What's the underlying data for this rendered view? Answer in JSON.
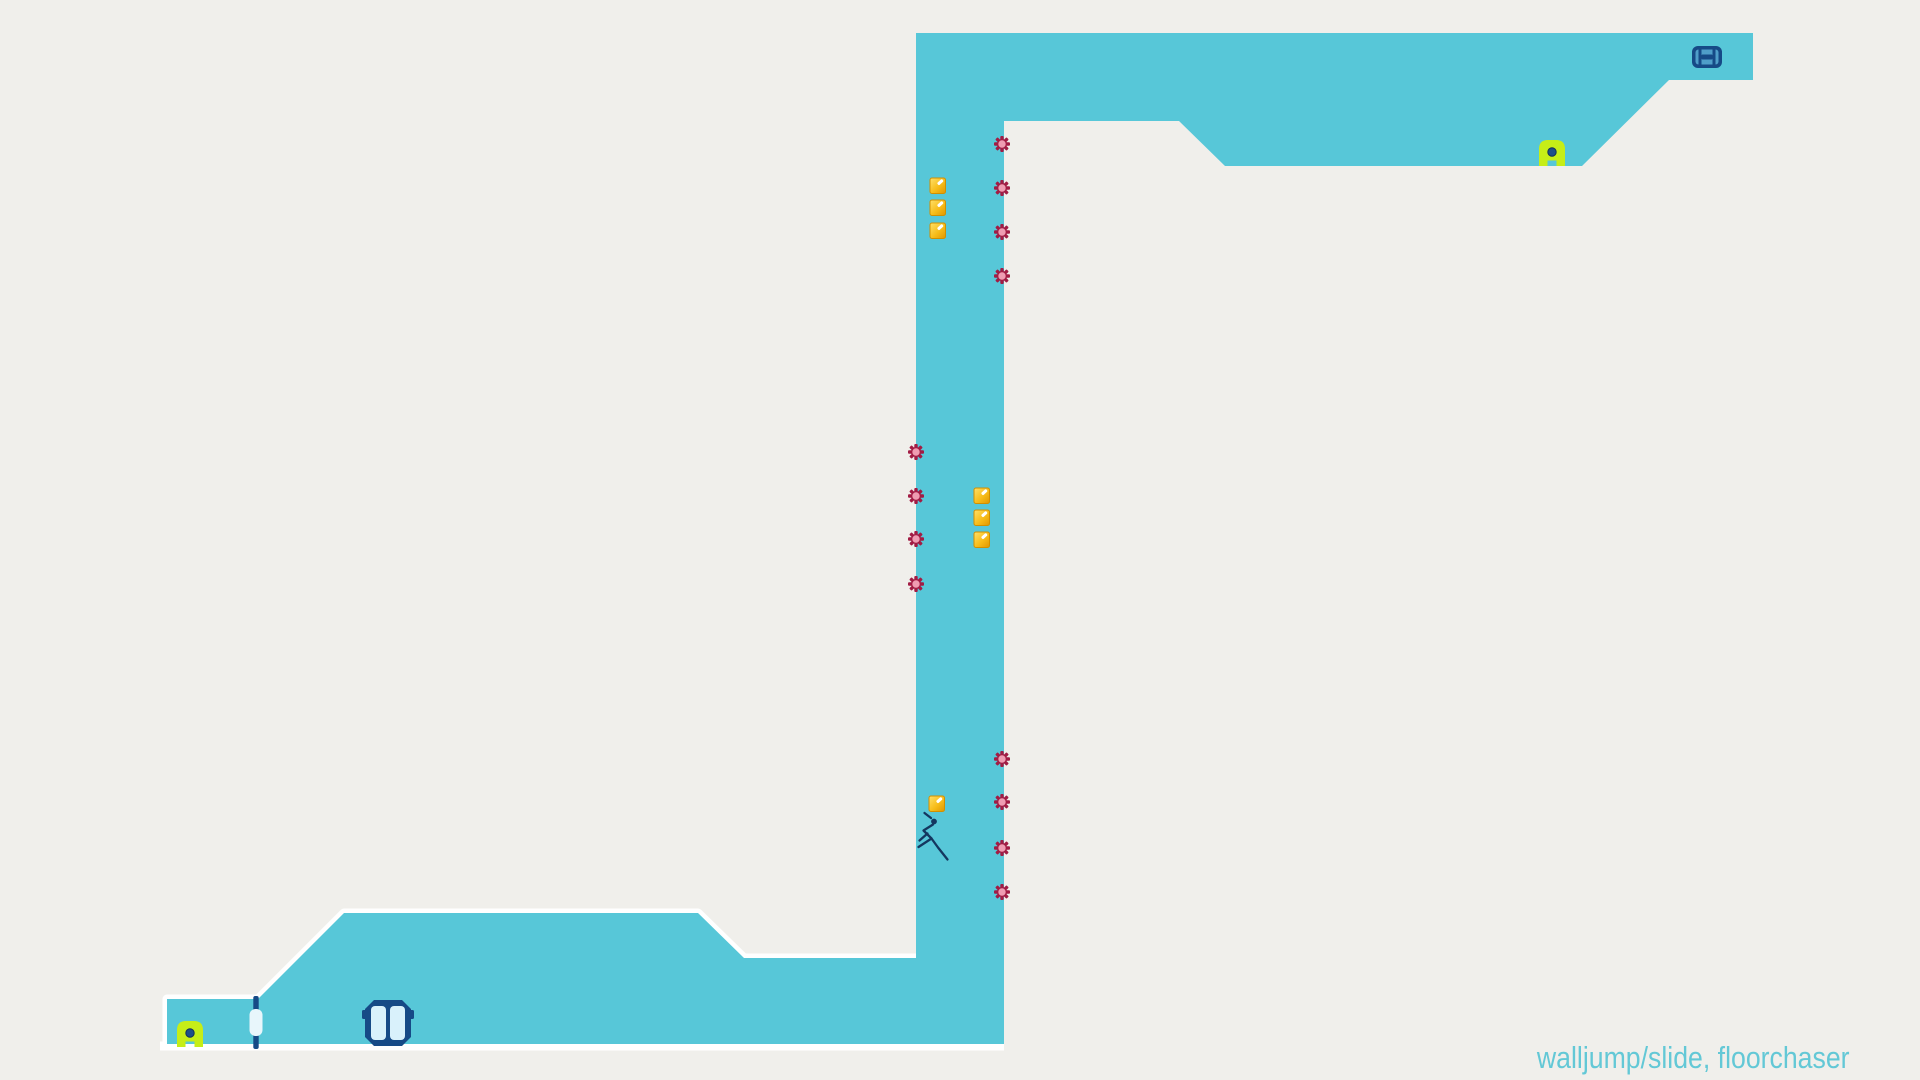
{
  "caption": "walljump/slide, floorchaser",
  "colors": {
    "bg": "#f0efeb",
    "terrain": "#57c7d8",
    "boundary": "#ffffff",
    "caption": "#63c8d6",
    "navy": "#164a86",
    "navy_dark": "#123a66",
    "door_panel": "#d9f1fb",
    "door_pill": "#e8f6fb",
    "switch_inner": "#4f9ec9",
    "gold_light": "#ffe06a",
    "gold_mid": "#f7bd1a",
    "gold_dark": "#e09600",
    "gold_edge": "#d18f00",
    "gold_shine": "#ffffff",
    "mine_dark": "#a21c44",
    "mine_light": "#ef9cb2",
    "guard_body": "#c6ee17",
    "guard_eye": "#1d4f8a",
    "guard_eye_rim": "#123057",
    "player_stroke": "#14375f"
  },
  "level": {
    "outline": [
      [
        916,
        33
      ],
      [
        1753,
        33
      ],
      [
        1753,
        80
      ],
      [
        1669,
        80
      ],
      [
        1582,
        166
      ],
      [
        1225,
        166
      ],
      [
        1179,
        121
      ],
      [
        1004,
        121
      ],
      [
        1004,
        1044
      ],
      [
        167,
        1044
      ],
      [
        167,
        999
      ],
      [
        258,
        999
      ],
      [
        344,
        913
      ],
      [
        698,
        913
      ],
      [
        744,
        958
      ],
      [
        916,
        958
      ]
    ],
    "white_outline_path": "M167,1050 L167,999 L258,999 L344,913 L698,913 L744,958 L916,958 M160,1046 L1004,1046"
  },
  "objects": {
    "mines": [
      {
        "x": 1002,
        "y": 144
      },
      {
        "x": 1002,
        "y": 188
      },
      {
        "x": 1002,
        "y": 232
      },
      {
        "x": 1002,
        "y": 276
      },
      {
        "x": 916,
        "y": 452
      },
      {
        "x": 916,
        "y": 496
      },
      {
        "x": 916,
        "y": 539
      },
      {
        "x": 916,
        "y": 584
      },
      {
        "x": 1002,
        "y": 759
      },
      {
        "x": 1002,
        "y": 802
      },
      {
        "x": 1002,
        "y": 848
      },
      {
        "x": 1002,
        "y": 892
      }
    ],
    "gold": [
      {
        "x": 930,
        "y": 178
      },
      {
        "x": 930,
        "y": 200
      },
      {
        "x": 930,
        "y": 223
      },
      {
        "x": 974,
        "y": 488
      },
      {
        "x": 974,
        "y": 510
      },
      {
        "x": 974,
        "y": 532
      },
      {
        "x": 929,
        "y": 796
      }
    ],
    "floorguards": [
      {
        "x": 1539,
        "y": 140
      },
      {
        "x": 177,
        "y": 1021
      }
    ],
    "door": {
      "x": 256,
      "top_cap_y": 996,
      "bottom_cap_y": 1034,
      "cap_h": 15,
      "pill_y": 1009,
      "pill_h": 27,
      "pill_w": 13
    },
    "exit_door": {
      "x": 365,
      "y": 1000,
      "w": 46,
      "h": 46,
      "bevel": 9
    },
    "exit_switch": {
      "x": 1692,
      "y": 46,
      "w": 30,
      "h": 22
    },
    "player": {
      "head": {
        "cx": 934,
        "cy": 821.5,
        "r": 2.9
      },
      "limb_paths": [
        "M933,824.5 L923.5,830.5 L931.5,838.5 L918.5,847",
        "M931.5,838.5 L938,847.5 L947.5,859.5",
        "M927.5,833.5 L919.5,840.5",
        "M931,818 L924.5,813"
      ]
    }
  }
}
